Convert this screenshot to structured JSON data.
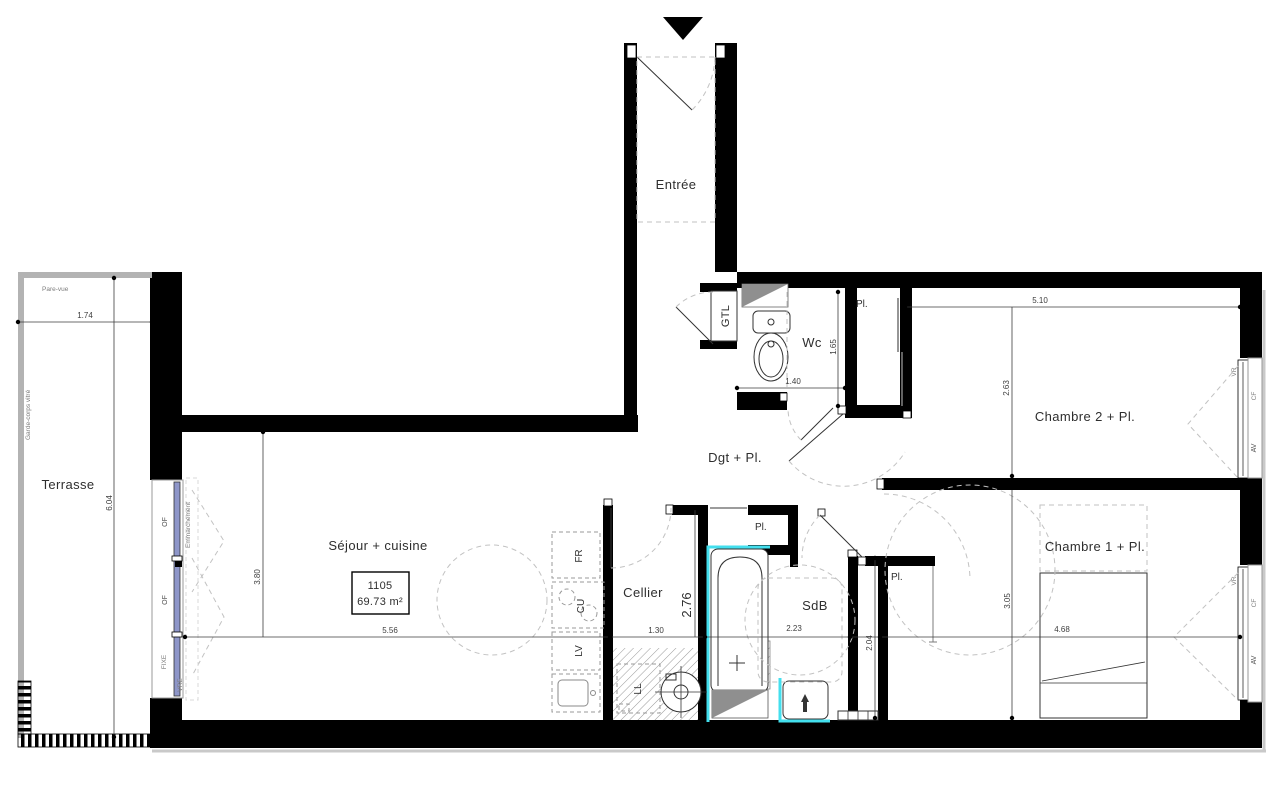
{
  "plan": {
    "unit": {
      "number": "1105",
      "area": "69.73 m²"
    },
    "rooms": {
      "entree": "Entrée",
      "wc": "Wc",
      "dgt": "Dgt + Pl.",
      "chambre2": "Chambre 2 + Pl.",
      "chambre1": "Chambre 1 + Pl.",
      "sejour": "Séjour + cuisine",
      "cellier": "Cellier",
      "sdb": "SdB",
      "terrasse": "Terrasse",
      "pl": "Pl."
    },
    "dims": {
      "terrasse_w": "1.74",
      "terrasse_h": "6.04",
      "sejour_h": "3.80",
      "sejour_w": "5.56",
      "cellier_w": "1.30",
      "cellier_h": "2.76",
      "wc_w": "1.40",
      "wc_h": "1.65",
      "ch2_w": "5.10",
      "ch2_h": "2.63",
      "sdb_w": "2.23",
      "sdb_h": "2.04",
      "ch1_w": "4.68",
      "ch1_h": "3.05"
    },
    "tags": {
      "gtl": "GTL",
      "fr": "FR",
      "cu": "CU",
      "lv": "LV",
      "ll": "LL",
      "of": "OF",
      "fixe": "FIXE",
      "vre": "VRE",
      "vr": "VR",
      "cf": "CF",
      "av": "AV",
      "pare_vue": "Pare-vue",
      "garde_corps": "Garde-corps vitré",
      "emmarchement": "Emmarchement"
    },
    "colors": {
      "wall": "#000000",
      "accent_cyan": "#43dfee",
      "glazing": "#8e96c9",
      "shaft_gray": "#8f8f8f",
      "dash_gray": "#c2c2c2",
      "rail_gray": "#b3b3b3",
      "text": "#2e2e2e"
    }
  }
}
